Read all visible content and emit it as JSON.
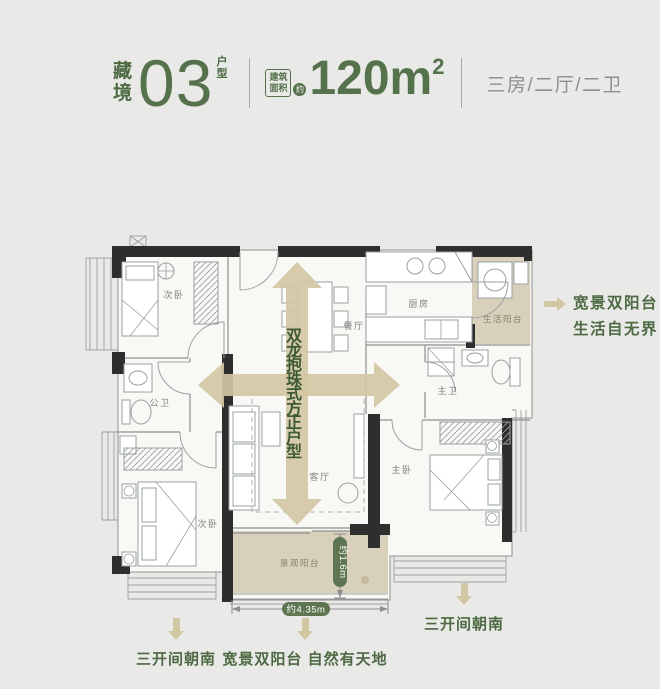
{
  "header": {
    "brand_char1": "藏",
    "brand_char2": "境",
    "unit_number": "03",
    "unit_label_char1": "户",
    "unit_label_char2": "型",
    "badge_line1": "建筑",
    "badge_line2": "面积",
    "badge_approx": "约",
    "area_value": "120m",
    "area_exponent": "2",
    "spec": "三房/二厅/二卫"
  },
  "rooms": {
    "bedroom_top": "次卧",
    "bath_public": "公卫",
    "bedroom_bottom": "次卧",
    "dining": "餐厅",
    "living": "客厅",
    "kitchen": "厨房",
    "balcony_service": "生活阳台",
    "bath_master": "主卫",
    "bedroom_master": "主卧",
    "balcony_view": "景观阳台"
  },
  "annotations": {
    "slogan_vertical": "双龙抱珠式方正户型",
    "callout_right_line1": "宽景双阳台",
    "callout_right_line2": "生活自无界",
    "caption_bottom_left": "三开间朝南",
    "caption_bottom_center": "宽景双阳台 自然有天地",
    "caption_bottom_right": "三开间朝南",
    "dim_width": "约4.35m",
    "dim_depth": "约1.6m"
  },
  "colors": {
    "background": "#e9e9e7",
    "accent_green": "#56724c",
    "text_green_dark": "#3e5a35",
    "text_gray": "#8e8e8e",
    "arrow_tan": "#d2c7a3",
    "balcony_fill": "#d9d0bb",
    "wall_black": "#2e2e2e",
    "dim_pill_green": "#5d7551"
  }
}
